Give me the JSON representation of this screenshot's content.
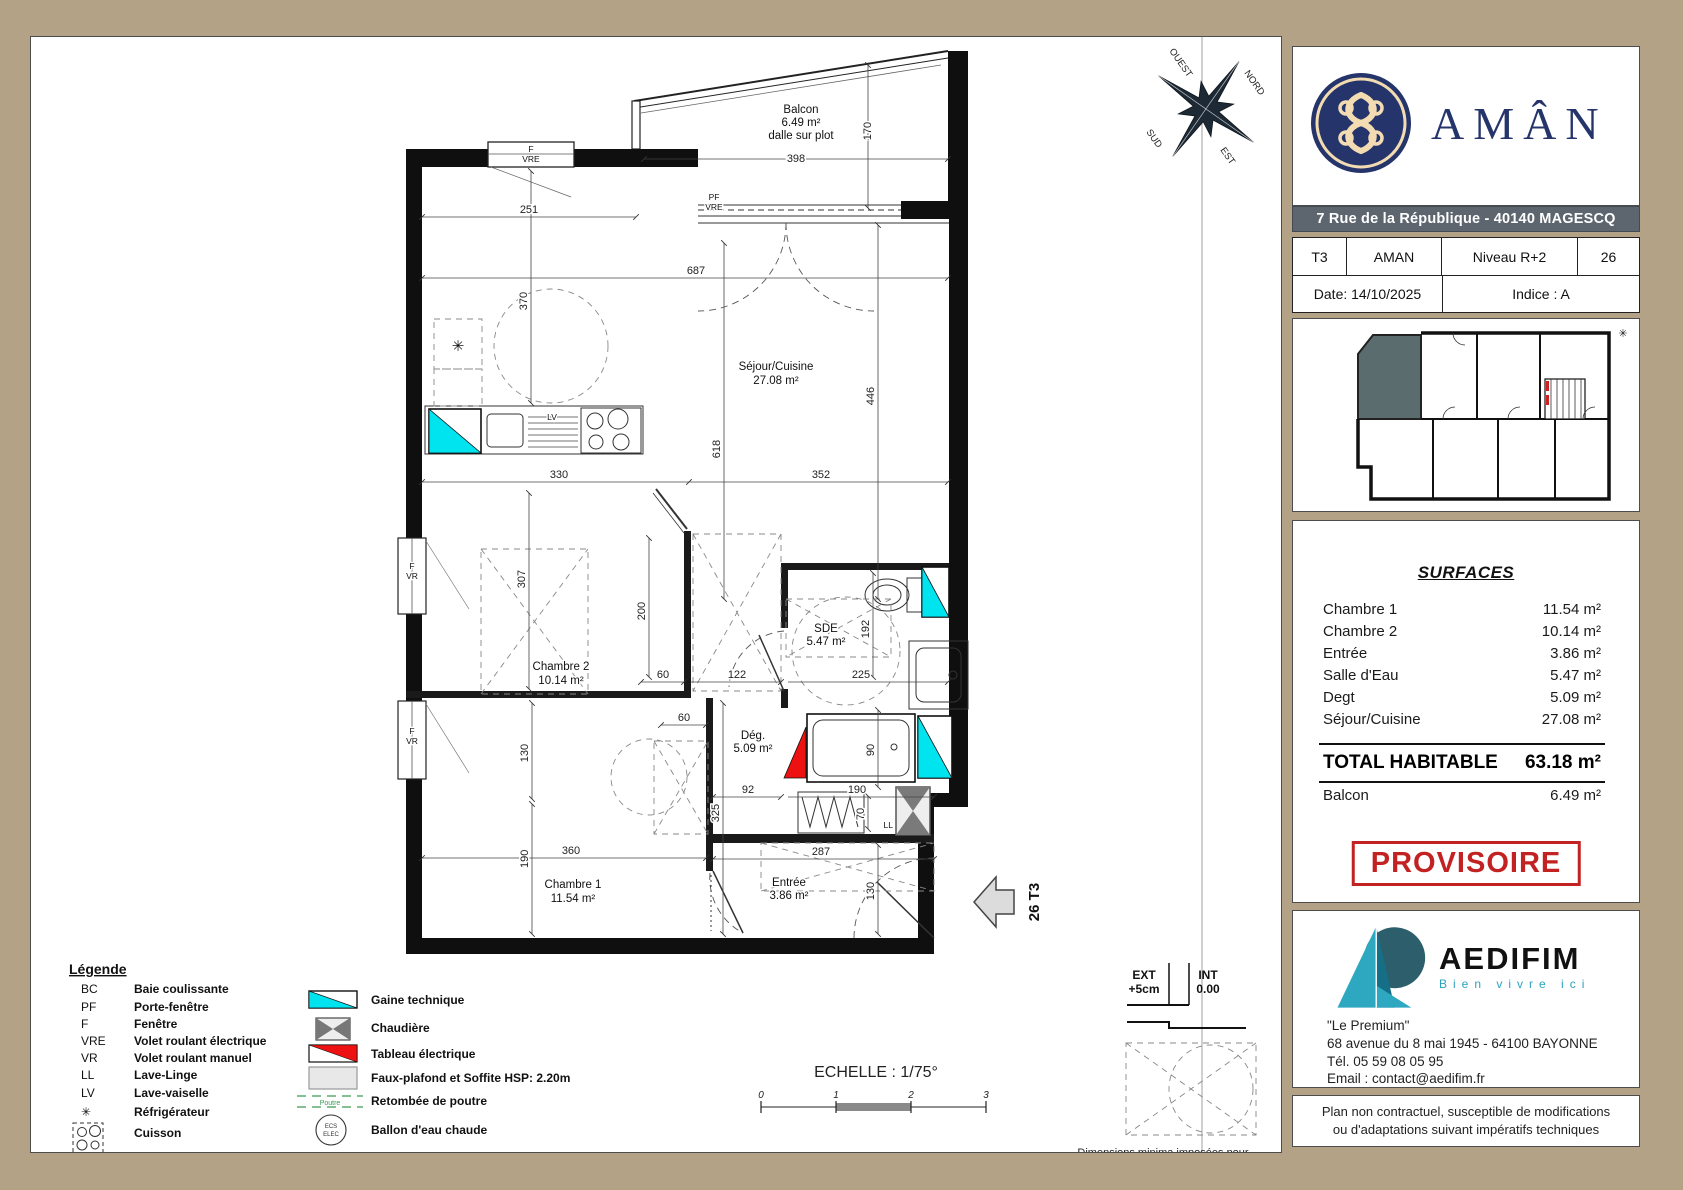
{
  "plan": {
    "rooms": {
      "balcon": {
        "name": "Balcon",
        "area": "6.49 m²",
        "note": "dalle sur plot"
      },
      "sejour": {
        "name": "Séjour/Cuisine",
        "area": "27.08 m²"
      },
      "chambre2": {
        "name": "Chambre 2",
        "area": "10.14 m²"
      },
      "chambre1": {
        "name": "Chambre 1",
        "area": "11.54 m²"
      },
      "sde": {
        "name": "SDE",
        "area": "5.47 m²"
      },
      "deg": {
        "name": "Dég.",
        "area": "5.09 m²"
      },
      "entree": {
        "name": "Entrée",
        "area": "3.86 m²"
      }
    },
    "dims": {
      "d398": "398",
      "d170": "170",
      "d251": "251",
      "d687": "687",
      "d370": "370",
      "d618": "618",
      "d446": "446",
      "d330": "330",
      "d352": "352",
      "d307": "307",
      "d200": "200",
      "d60": "60",
      "d122": "122",
      "d225": "225",
      "d192": "192",
      "d130": "130",
      "d90": "90",
      "d190": "190",
      "d70": "70",
      "d92": "92",
      "d325": "325",
      "d287": "287",
      "d360": "360"
    },
    "openings": {
      "f": "F",
      "vre": "VRE",
      "vr": "VR",
      "pf": "PF"
    },
    "appliances": {
      "lv": "LV",
      "ll": "LL",
      "fridge": "✳"
    },
    "unit_arrow": "26 T3",
    "compass": {
      "nord": "NORD",
      "est": "EST",
      "sud": "SUD",
      "ouest": "OUEST"
    },
    "threshold": {
      "ext": "EXT",
      "ext_val": "+5cm",
      "int": "INT",
      "int_val": "0.00"
    },
    "accessibility": {
      "line1": "Dimensions minima imposées pour",
      "line2": "l'accessibilité handicapés"
    },
    "scale": {
      "label": "ECHELLE : 1/75°",
      "t0": "0",
      "t1": "1",
      "t2": "2",
      "t3": "3"
    }
  },
  "legend": {
    "title": "Légende",
    "abbr": [
      {
        "k": "BC",
        "v": "Baie coulissante"
      },
      {
        "k": "PF",
        "v": "Porte-fenêtre"
      },
      {
        "k": "F",
        "v": "Fenêtre"
      },
      {
        "k": "VRE",
        "v": "Volet roulant électrique"
      },
      {
        "k": "VR",
        "v": "Volet roulant manuel"
      },
      {
        "k": "LL",
        "v": "Lave-Linge"
      },
      {
        "k": "LV",
        "v": "Lave-vaiselle"
      },
      {
        "k": "✳",
        "v": "Réfrigérateur"
      },
      {
        "k": "",
        "v": "Cuisson"
      }
    ],
    "symbols": [
      {
        "v": "Gaine technique"
      },
      {
        "v": "Chaudière"
      },
      {
        "v": "Tableau électrique"
      },
      {
        "v": "Faux-plafond et Soffite HSP: 2.20m"
      },
      {
        "v": "Retombée de poutre"
      },
      {
        "v": "Ballon d'eau chaude"
      }
    ],
    "poutre": "Poutre",
    "ecs_line1": "ECS",
    "ecs_line2": "ELEC"
  },
  "titleblock": {
    "brand": "AMÂN",
    "address_bar": "7 Rue de la République - 40140 MAGESCQ",
    "info": {
      "type": "T3",
      "program": "AMAN",
      "level": "Niveau R+2",
      "lot": "26",
      "date": "Date: 14/10/2025",
      "indice": "Indice : A"
    },
    "surfaces": {
      "title": "SURFACES",
      "rows": [
        {
          "label": "Chambre 1",
          "value": "11.54 m²"
        },
        {
          "label": "Chambre 2",
          "value": "10.14 m²"
        },
        {
          "label": "Entrée",
          "value": "3.86 m²"
        },
        {
          "label": "Salle d'Eau",
          "value": "5.47 m²"
        },
        {
          "label": "Degt",
          "value": "5.09 m²"
        },
        {
          "label": "Séjour/Cuisine",
          "value": "27.08 m²"
        }
      ],
      "total_label": "TOTAL HABITABLE",
      "total_value": "63.18 m²",
      "balcony_label": "Balcon",
      "balcony_value": "6.49 m²"
    },
    "stamp": "PROVISOIRE",
    "agency": {
      "name": "AEDIFIM",
      "tagline": "Bien vivre ici",
      "line1": "\"Le Premium\"",
      "line2": "68 avenue du 8 mai 1945 - 64100 BAYONNE",
      "line3": "Tél. 05 59 08 05 95",
      "line4": "Email :  contact@aedifim.fr"
    },
    "footer": {
      "line1": "Plan non contractuel, susceptible de modifications",
      "line2": "ou d'adaptations suivant impératifs techniques"
    }
  },
  "colors": {
    "tan": "#b4a287",
    "navy": "#25356b",
    "cream": "#f3dcb2",
    "slate": "#5d666f",
    "cyan": "#00e4f0",
    "red": "#ee1111",
    "stamp": "#c32222",
    "teal": "#2ba3bd"
  }
}
